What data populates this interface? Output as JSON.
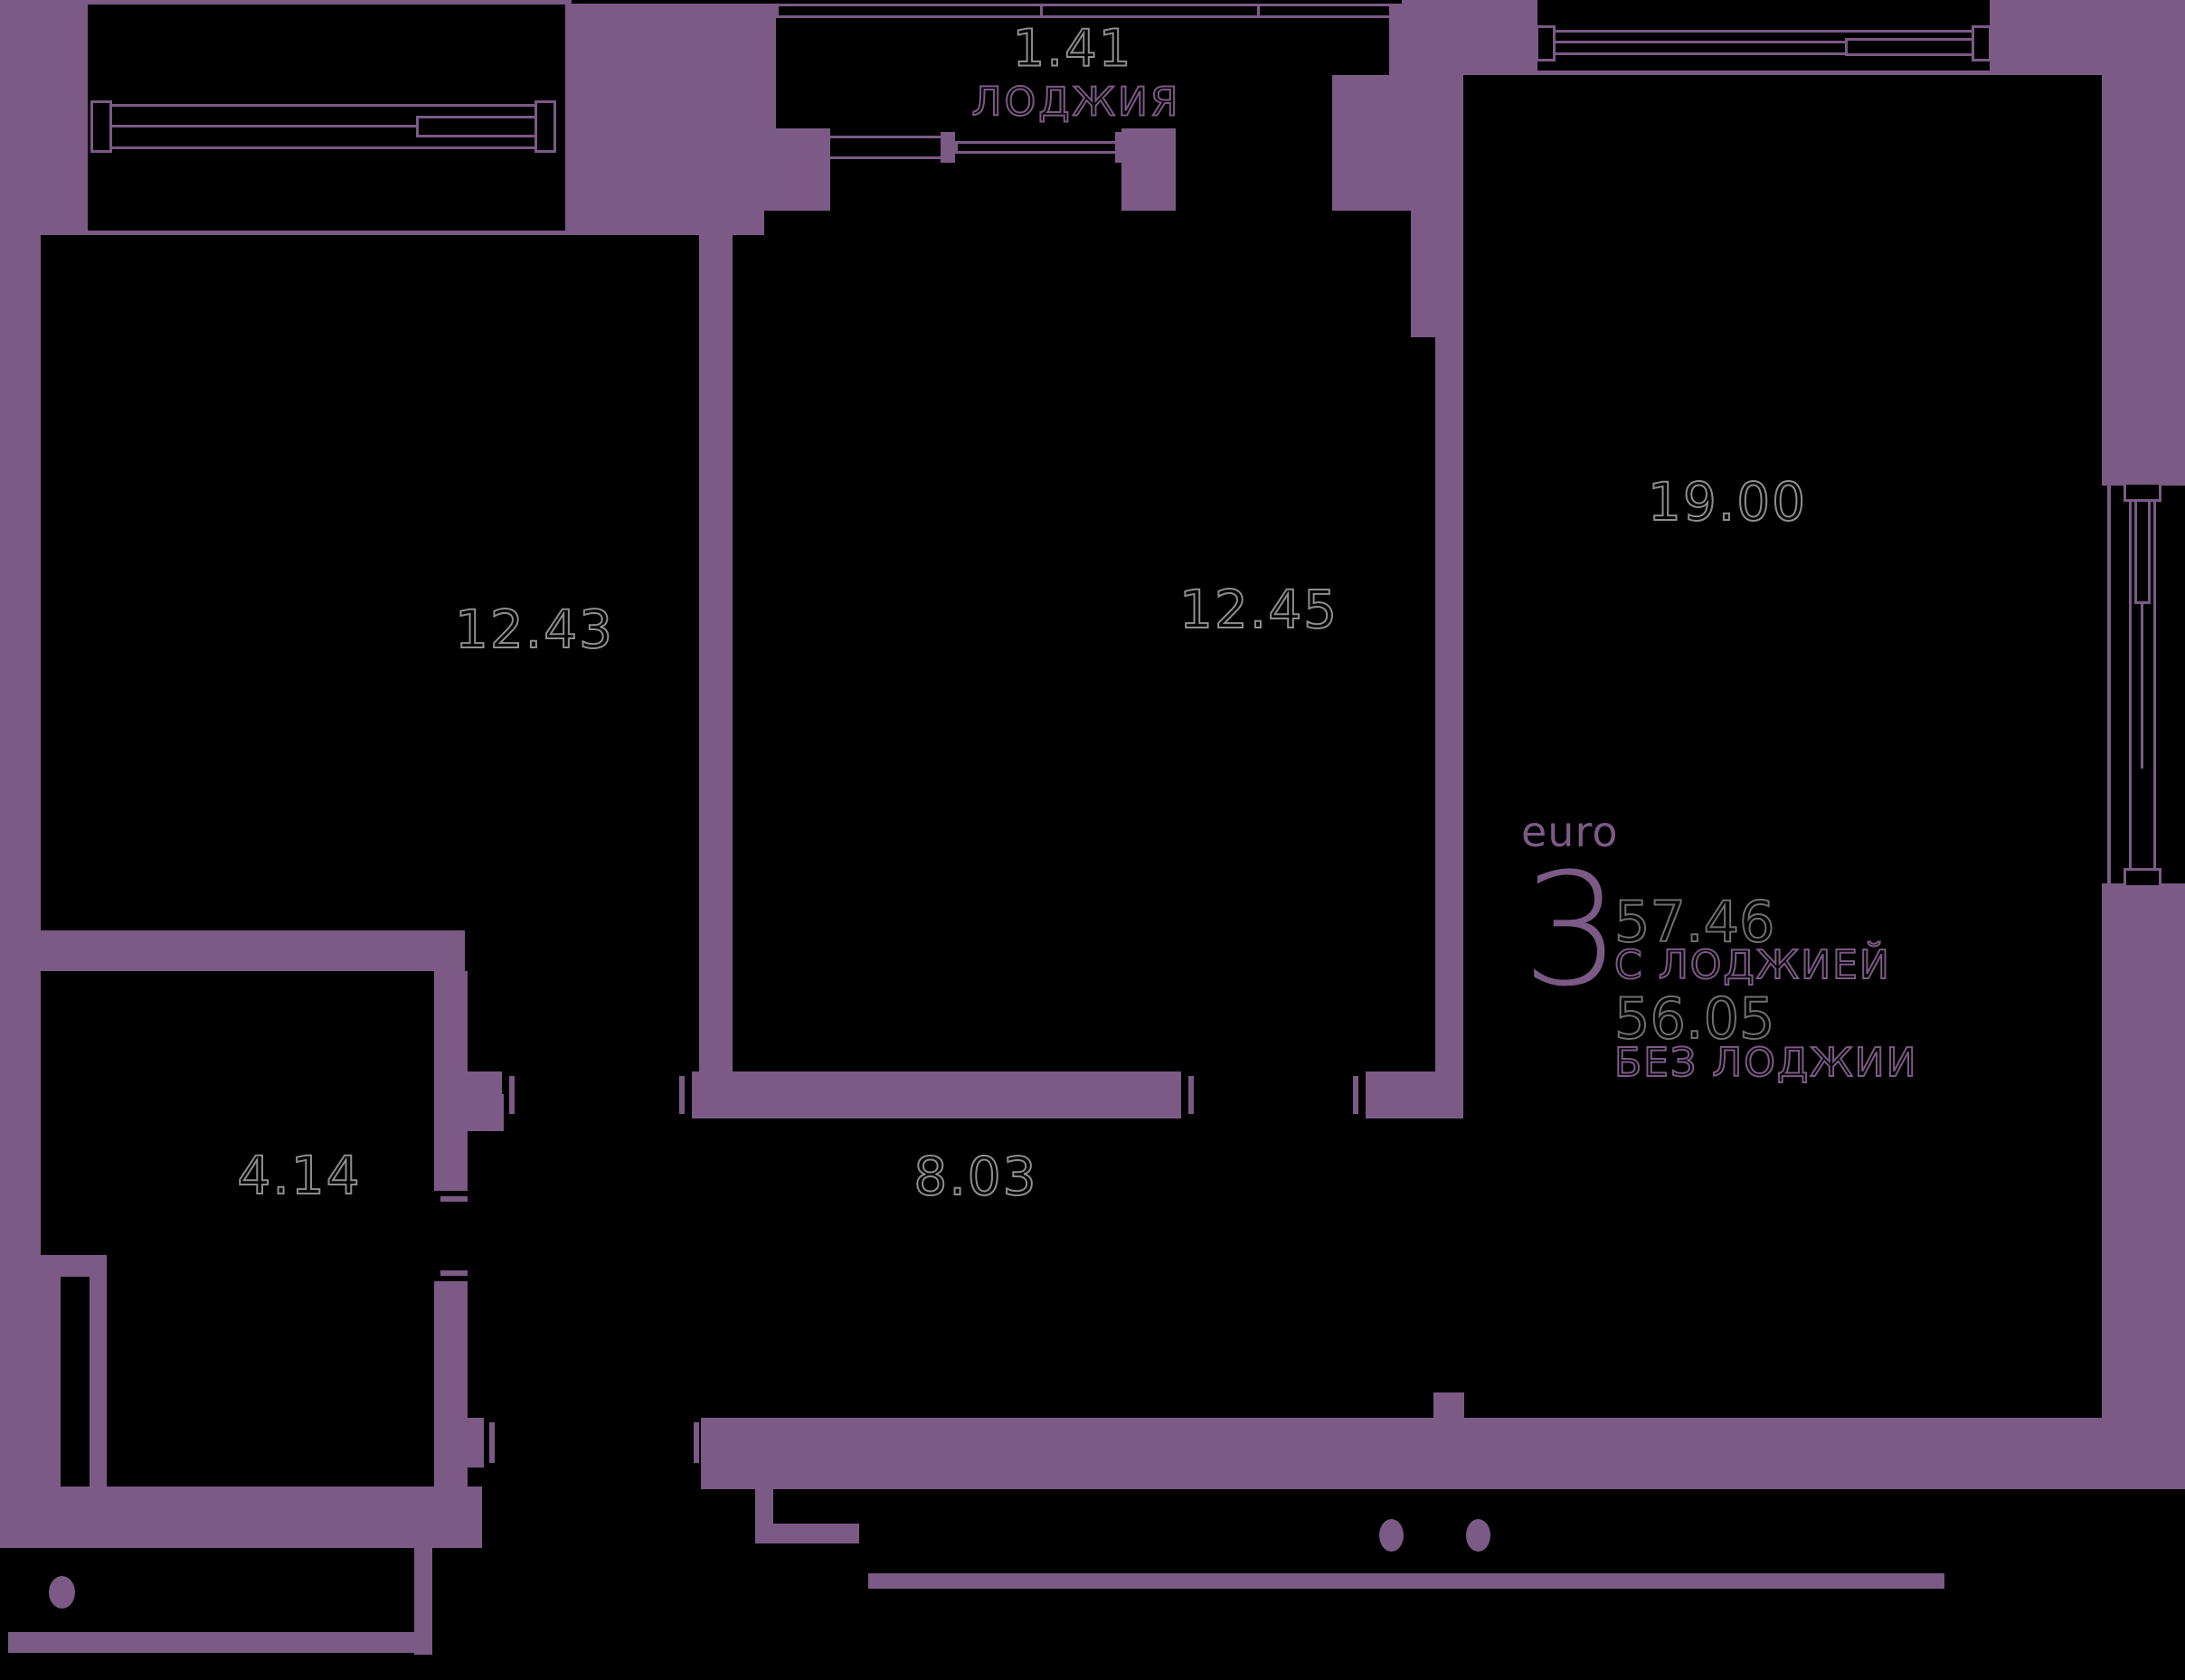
{
  "plan": {
    "type": "apartment-floor-plan",
    "colors": {
      "walls_accent": "#7B5A86",
      "background": "#000000",
      "area_number_outline": "#8E8E8E"
    },
    "rooms": [
      {
        "id": "loggia",
        "area": "1.41",
        "label": "ЛОДЖИЯ"
      },
      {
        "id": "room-left",
        "area": "12.43",
        "label": ""
      },
      {
        "id": "room-middle",
        "area": "12.45",
        "label": ""
      },
      {
        "id": "kitchen-living",
        "area": "19.00",
        "label": ""
      },
      {
        "id": "bathroom",
        "area": "4.14",
        "label": ""
      },
      {
        "id": "hallway",
        "area": "8.03",
        "label": ""
      }
    ],
    "info": {
      "format_label": "euro",
      "rooms_count": "3",
      "area_with_loggia": "57.46",
      "with_loggia_label": "С ЛОДЖИЕЙ",
      "area_without_loggia": "56.05",
      "without_loggia_label": "БЕЗ ЛОДЖИИ"
    }
  }
}
